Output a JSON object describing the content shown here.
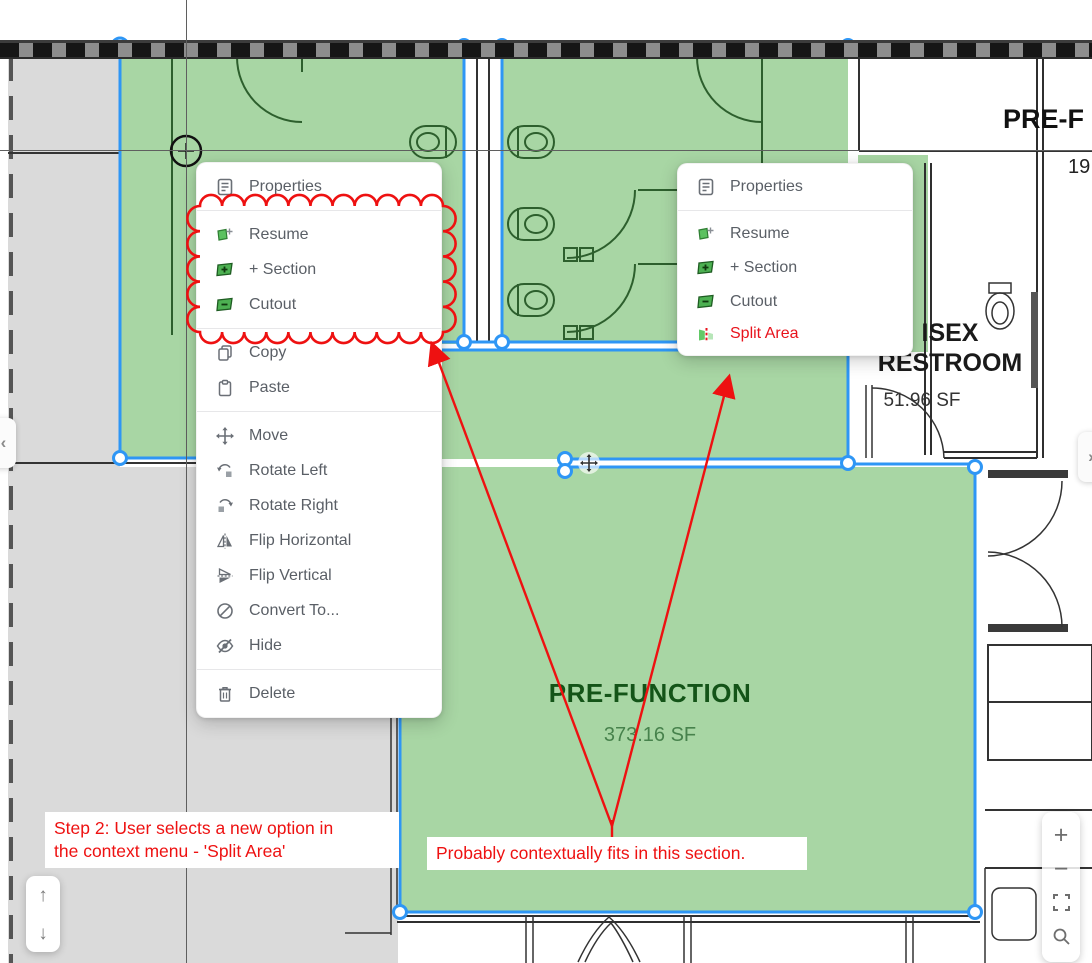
{
  "plan": {
    "pre_function": {
      "title": "PRE-FUNCTION",
      "area": "373.16 SF"
    },
    "restroom": {
      "title_line1": "ISEX",
      "title_line2": "RESTROOM",
      "area": "51.96 SF"
    },
    "corner_label": {
      "title": "PRE-F",
      "area": "19"
    }
  },
  "context_menu_left": {
    "items": [
      {
        "label": "Properties",
        "icon": "properties-icon"
      },
      {
        "label": "Resume",
        "icon": "resume-icon"
      },
      {
        "label": "+ Section",
        "icon": "add-section-icon"
      },
      {
        "label": "Cutout",
        "icon": "cutout-icon"
      },
      {
        "label": "Copy",
        "icon": "copy-icon"
      },
      {
        "label": "Paste",
        "icon": "paste-icon"
      },
      {
        "label": "Move",
        "icon": "move-icon"
      },
      {
        "label": "Rotate Left",
        "icon": "rotate-left-icon"
      },
      {
        "label": "Rotate Right",
        "icon": "rotate-right-icon"
      },
      {
        "label": "Flip Horizontal",
        "icon": "flip-horizontal-icon"
      },
      {
        "label": "Flip Vertical",
        "icon": "flip-vertical-icon"
      },
      {
        "label": "Convert To...",
        "icon": "convert-to-icon"
      },
      {
        "label": "Hide",
        "icon": "hide-icon"
      },
      {
        "label": "Delete",
        "icon": "delete-icon"
      }
    ]
  },
  "context_menu_right": {
    "items": [
      {
        "label": "Properties",
        "icon": "properties-icon"
      },
      {
        "label": "Resume",
        "icon": "resume-icon"
      },
      {
        "label": "+ Section",
        "icon": "add-section-icon"
      },
      {
        "label": "Cutout",
        "icon": "cutout-icon"
      },
      {
        "label": "Split Area",
        "icon": "split-area-icon",
        "color": "#e8131c"
      }
    ]
  },
  "annotations": {
    "step2_line1": "Step 2: User selects a new option in",
    "step2_line2": "the context menu - 'Split Area'",
    "note": "Probably contextually fits in this section.",
    "color": "#ee1111"
  },
  "controls": {
    "pan_up": "↑",
    "pan_down": "↓",
    "zoom_in": "+",
    "zoom_out": "−",
    "page_prev": "‹",
    "page_next": "›"
  },
  "colors": {
    "selection_blue": "#2e96f5",
    "area_green": "#a8d6a4",
    "plan_dark_green": "#2d5f2d",
    "annotation_red": "#ee1111",
    "split_area_red": "#e8131c"
  }
}
